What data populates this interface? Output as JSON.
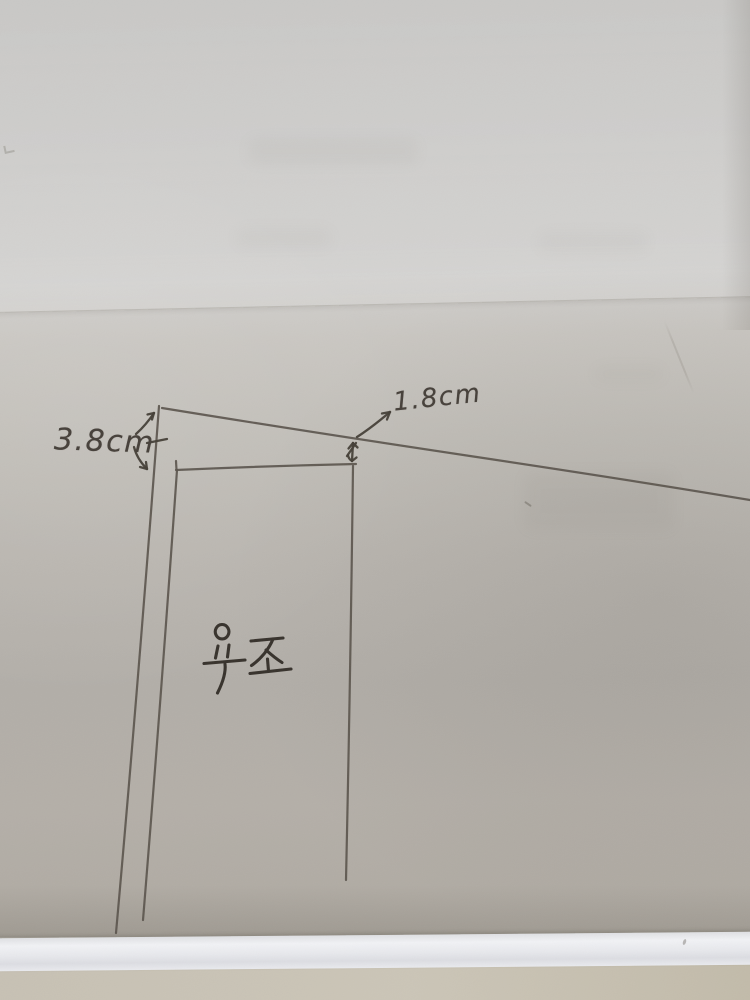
{
  "scene": {
    "type": "photograph of a hand-drawn sketch on paper",
    "subject": "pencil plan sketch of a bathtub with dimension annotations",
    "annotations": {
      "left_dimension": "3.8cm",
      "top_dimension": "1.8cm",
      "area_label": "욕조"
    },
    "colors": {
      "paper_light": "#cfcecc",
      "paper_dark": "#b2ada6",
      "pencil": "#5b554d",
      "ink": "#37322c",
      "paper_edge_band": "#f1f2f5",
      "under_surface": "#c7c1b4"
    }
  }
}
